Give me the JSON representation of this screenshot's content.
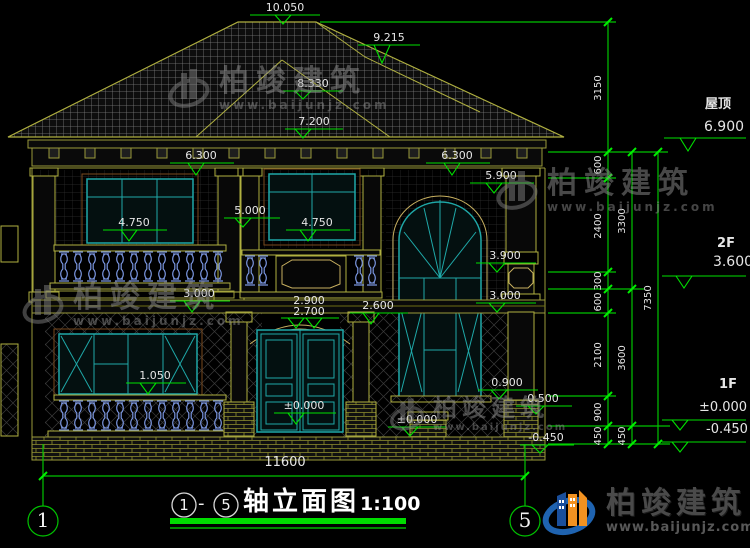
{
  "title": {
    "circle_from": "1",
    "dash": "-",
    "circle_to": "5",
    "name": "轴立面图",
    "scale": "1:100"
  },
  "axis_bubbles": {
    "left": "1",
    "right": "5"
  },
  "elev": {
    "ridge_main": "10.050",
    "ridge_right": "9.215",
    "ridge_front": "8.330",
    "porch_roof": "7.200",
    "eave_left": "6.300",
    "eave_right": "6.300",
    "window_head_right": "5.900",
    "capital_center": "5.000",
    "rail_left": "4.750",
    "rail_center": "4.750",
    "transom_right": "3.900",
    "band_left": "3.000",
    "band_right": "3.000",
    "arch_top": "2.900",
    "arch_spring": "2.700",
    "door_head": "2.600",
    "porch_rail": "1.050",
    "sill_right": "0.900",
    "pedestal_top": "0.500",
    "threshold": "±0.000",
    "ground_right": "±0.000",
    "grade_right": "-0.450"
  },
  "dims": {
    "total_width": "11600",
    "right_inner": {
      "s1": "3150",
      "s2": "600",
      "s3": "2400",
      "s4": "300",
      "s5": "600",
      "s6": "2100",
      "s7": "900",
      "s8": "450"
    },
    "right_middle": {
      "s1": "3300",
      "s2": "3600",
      "s3": "450"
    },
    "right_outer": {
      "s1": "7350"
    }
  },
  "floors": {
    "roof_label": "屋顶",
    "roof_elev": "6.900",
    "f2_label": "2F",
    "f2_elev": "3.600",
    "f1_label": "1F",
    "f1_elev": "±0.000",
    "grade_elev": "-0.450"
  },
  "brand": {
    "name": "柏竣建筑",
    "url": "www.baijunjz.com"
  },
  "colors": {
    "dim_green": "#00c300",
    "marker_green": "#00e000",
    "facade_olive": "#b0b040",
    "window_teal": "#1fa8a8",
    "baluster_blue": "#7b96e0",
    "roof_tile_gray": "#808080",
    "logo_blue": "#1f63b0",
    "logo_orange": "#f29221"
  }
}
